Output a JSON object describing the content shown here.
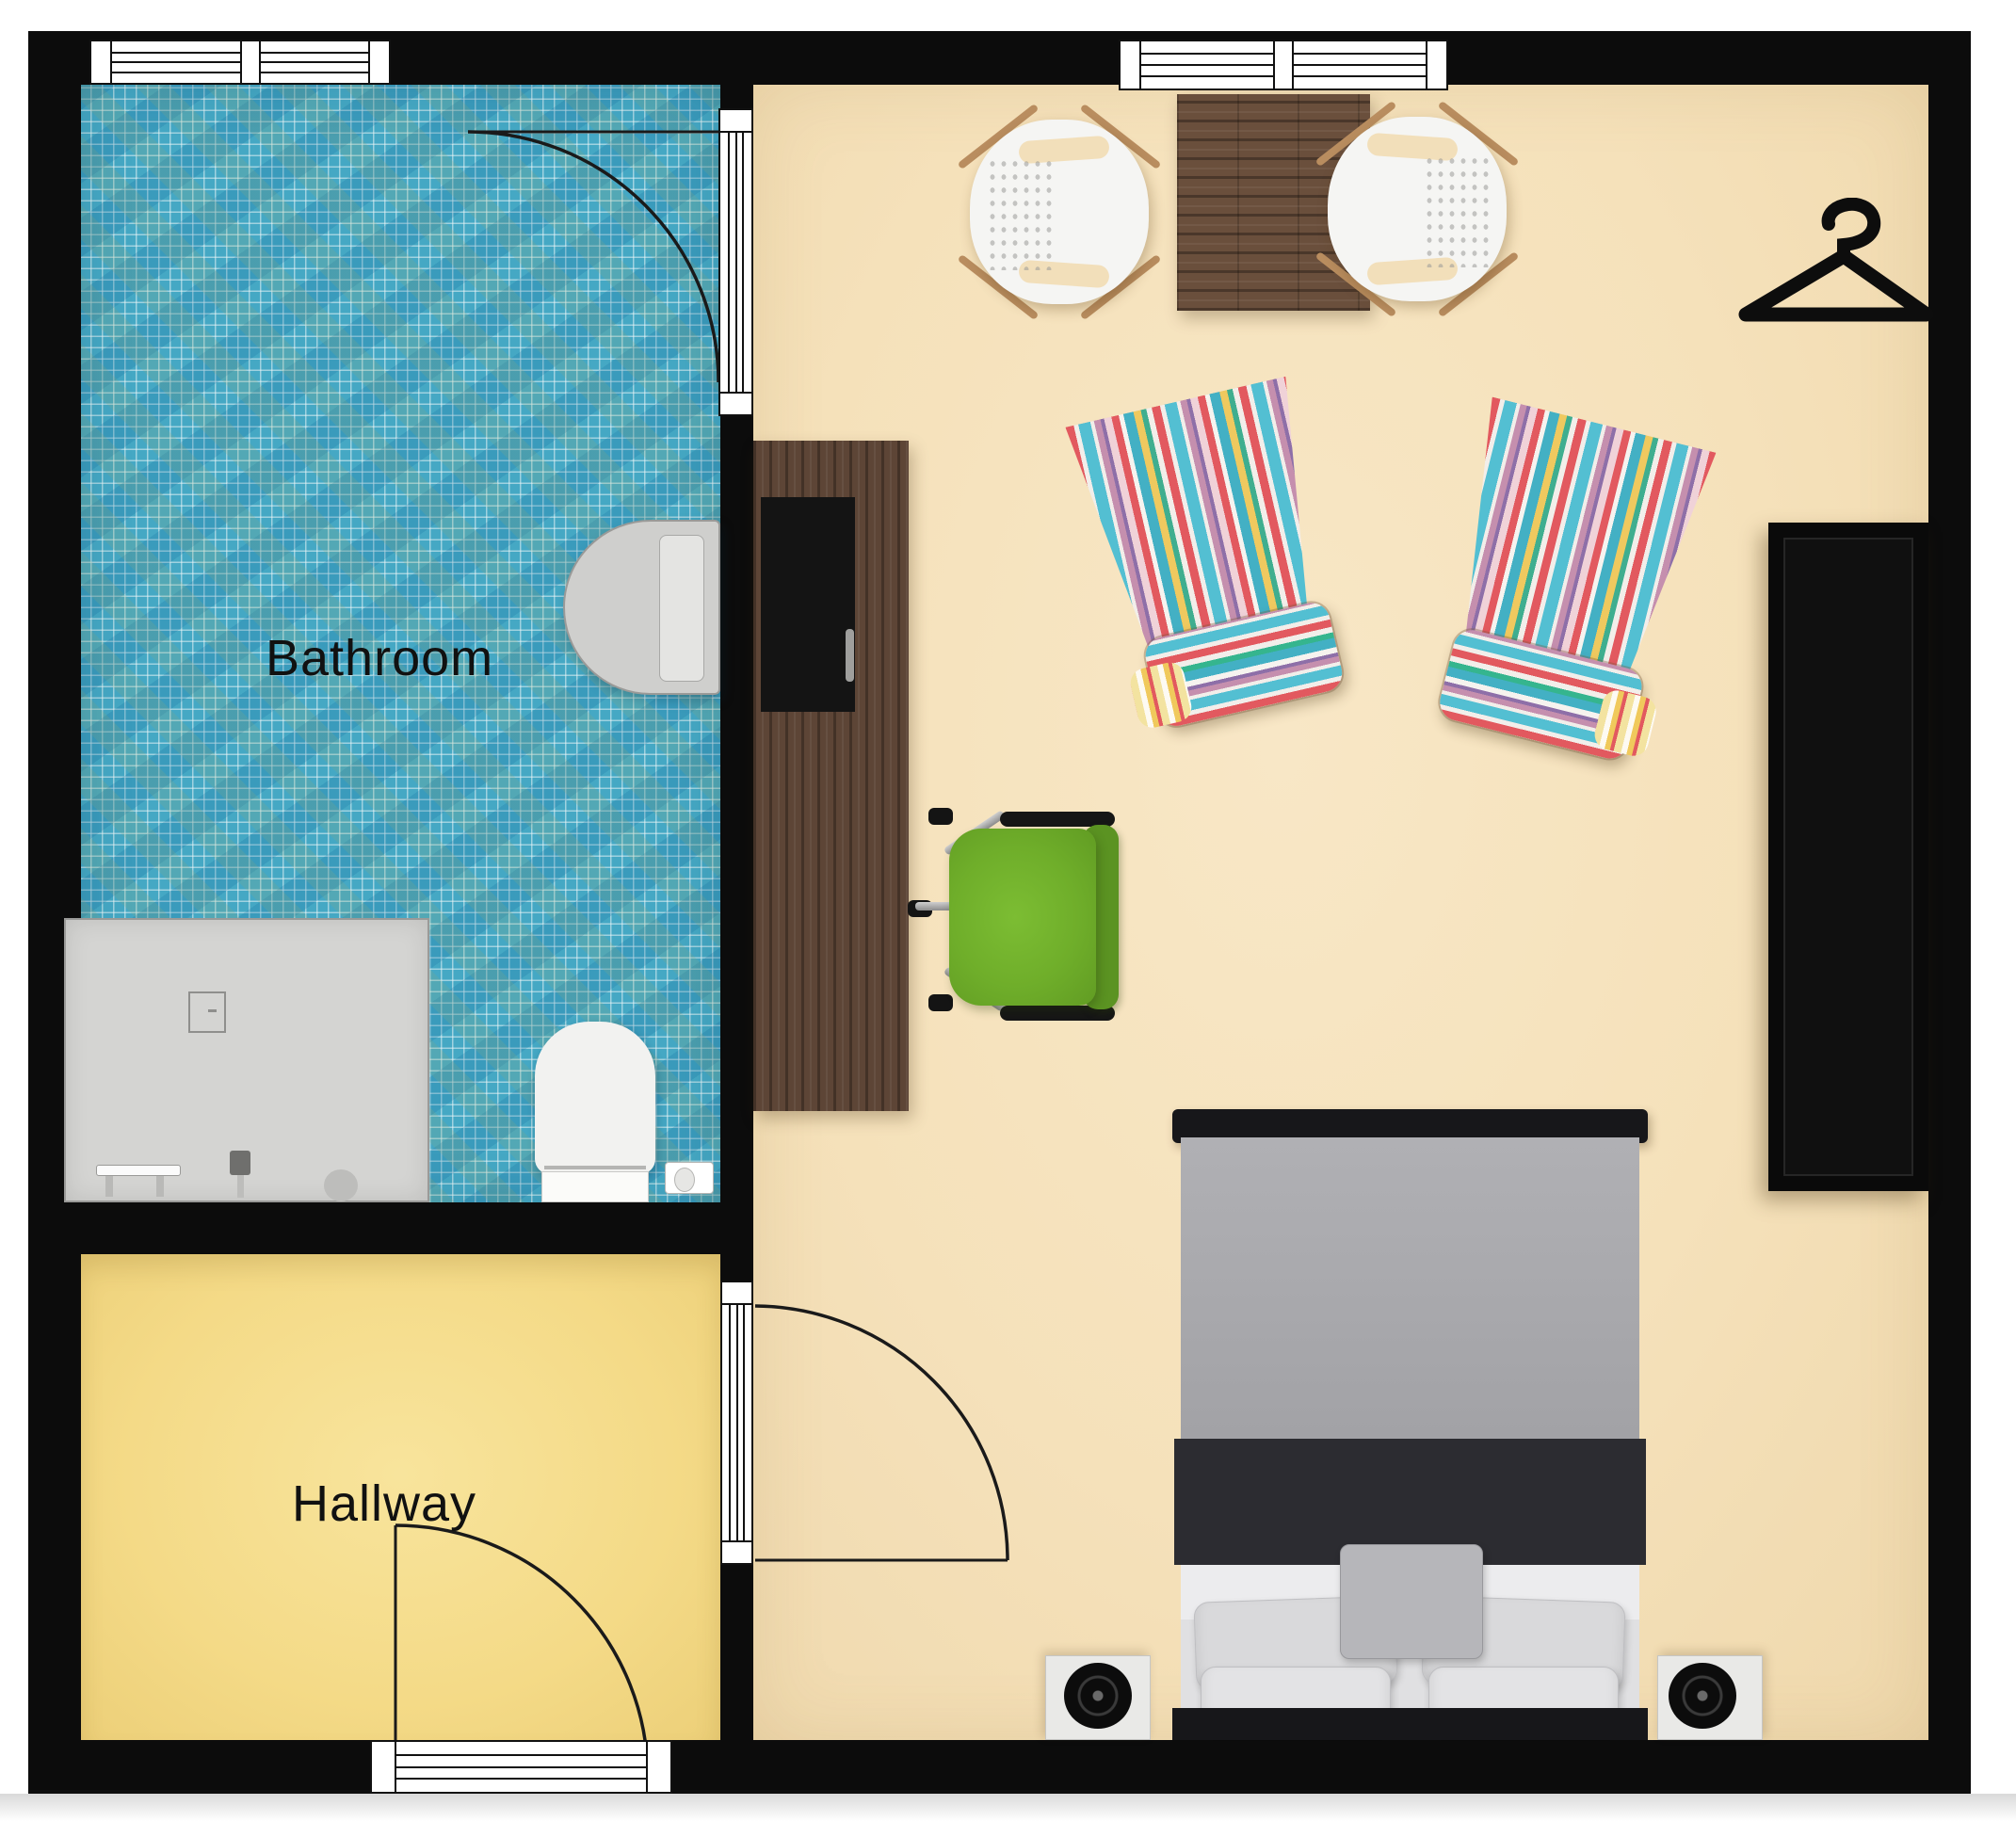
{
  "plan": {
    "type": "floor-plan",
    "view": "top-down",
    "rooms_count": 3
  },
  "rooms": [
    {
      "id": "bathroom",
      "label": "Bathroom",
      "floor": "blue mosaic tile",
      "floor_color": "#45a8c4"
    },
    {
      "id": "hallway",
      "label": "Hallway",
      "floor": "plain",
      "floor_color": "#f4da87"
    },
    {
      "id": "bedroom",
      "label": "",
      "floor": "plain",
      "floor_color": "#f5e1ba"
    }
  ],
  "walls": {
    "color": "#0c0c0c"
  },
  "doors": [
    {
      "id": "bathroom-door",
      "between": [
        "bathroom",
        "bedroom"
      ],
      "swing": "into bathroom"
    },
    {
      "id": "bedroom-door",
      "between": [
        "hallway",
        "bedroom"
      ],
      "swing": "into bedroom"
    },
    {
      "id": "entry-door",
      "between": [
        "hallway",
        "outside"
      ],
      "swing": "into hallway"
    }
  ],
  "windows": [
    {
      "id": "bathroom-window",
      "wall": "top"
    },
    {
      "id": "bedroom-window",
      "wall": "top"
    }
  ],
  "furniture": [
    {
      "id": "dining-table",
      "name": "wood dining table"
    },
    {
      "id": "dining-chair-left",
      "name": "white shell chair"
    },
    {
      "id": "dining-chair-right",
      "name": "white shell chair"
    },
    {
      "id": "hanger-icon",
      "name": "clothes hanger symbol"
    },
    {
      "id": "armchair-left",
      "name": "striped armchair"
    },
    {
      "id": "armchair-right",
      "name": "striped armchair"
    },
    {
      "id": "wardrobe",
      "name": "black wardrobe"
    },
    {
      "id": "desk",
      "name": "dark wood desk with monitor"
    },
    {
      "id": "desk-chair",
      "name": "green swivel chair"
    },
    {
      "id": "bed",
      "name": "double bed"
    },
    {
      "id": "nightstand-left",
      "name": "nightstand with lamp"
    },
    {
      "id": "nightstand-right",
      "name": "nightstand with lamp"
    },
    {
      "id": "bathroom-sink",
      "name": "wall-mounted sink"
    },
    {
      "id": "toilet",
      "name": "toilet"
    },
    {
      "id": "toilet-paper-holder",
      "name": "toilet paper holder"
    },
    {
      "id": "shower-tray",
      "name": "shower / vanity tray"
    }
  ],
  "colors": {
    "wall": "#0c0c0c",
    "bathroom_tile": "#45a8c4",
    "hallway_floor": "#f4da87",
    "bedroom_floor": "#f5e1ba",
    "bed_duvet": "#a8a8ac",
    "bed_band": "#2c2c31",
    "desk_wood": "#5d4536",
    "table_wood": "#6a4f3c",
    "chair_green": "#6fae2a",
    "stripe_red": "#e2595f",
    "stripe_teal": "#53bfd2",
    "stripe_yellow": "#efc95f"
  }
}
